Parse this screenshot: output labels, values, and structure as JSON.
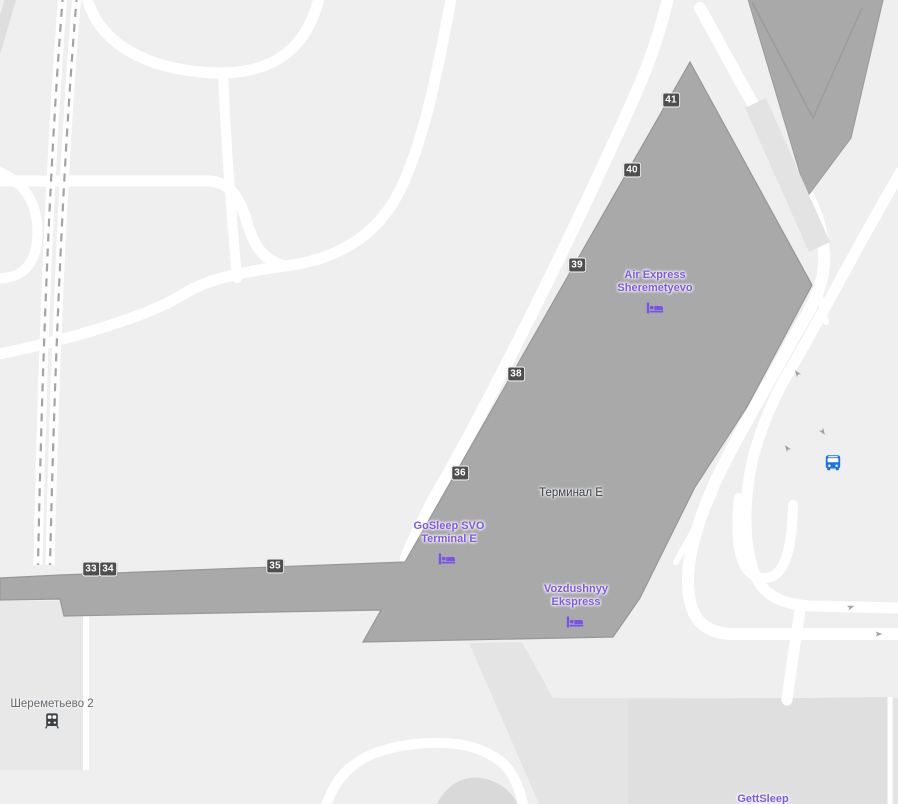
{
  "map": {
    "colors": {
      "background": "#efefef",
      "building_fill": "#a9a9a9",
      "building_outline": "#979797",
      "road": "#ffffff",
      "railway_dash": "#a3a3a3",
      "poi_purple": "#7e57e8",
      "transit_blue": "#1a73e8",
      "marker_bg": "#4e4e4e",
      "terminal_label_color": "#3d4247",
      "station_label_color": "#666c72"
    },
    "labels": {
      "terminal": "Терминал Е",
      "sheremetyevo2": "Шереметьево 2",
      "gettsleep": "GettSleep",
      "air_express": {
        "line1": "Air Express",
        "line2": "Sheremetyevo"
      },
      "gosleep": {
        "line1": "GoSleep SVO",
        "line2": "Terminal E"
      },
      "vozdushnyy": {
        "line1": "Vozdushnyy",
        "line2": "Ekspress"
      }
    },
    "gate_markers": [
      {
        "label": "33"
      },
      {
        "label": "34"
      },
      {
        "label": "35"
      },
      {
        "label": "36"
      },
      {
        "label": "38"
      },
      {
        "label": "39"
      },
      {
        "label": "40"
      },
      {
        "label": "41"
      }
    ],
    "icons": {
      "lodging": "bed-icon",
      "bus_stop": "bus-icon",
      "station": "train-icon",
      "one_way": "arrow-icon"
    }
  }
}
